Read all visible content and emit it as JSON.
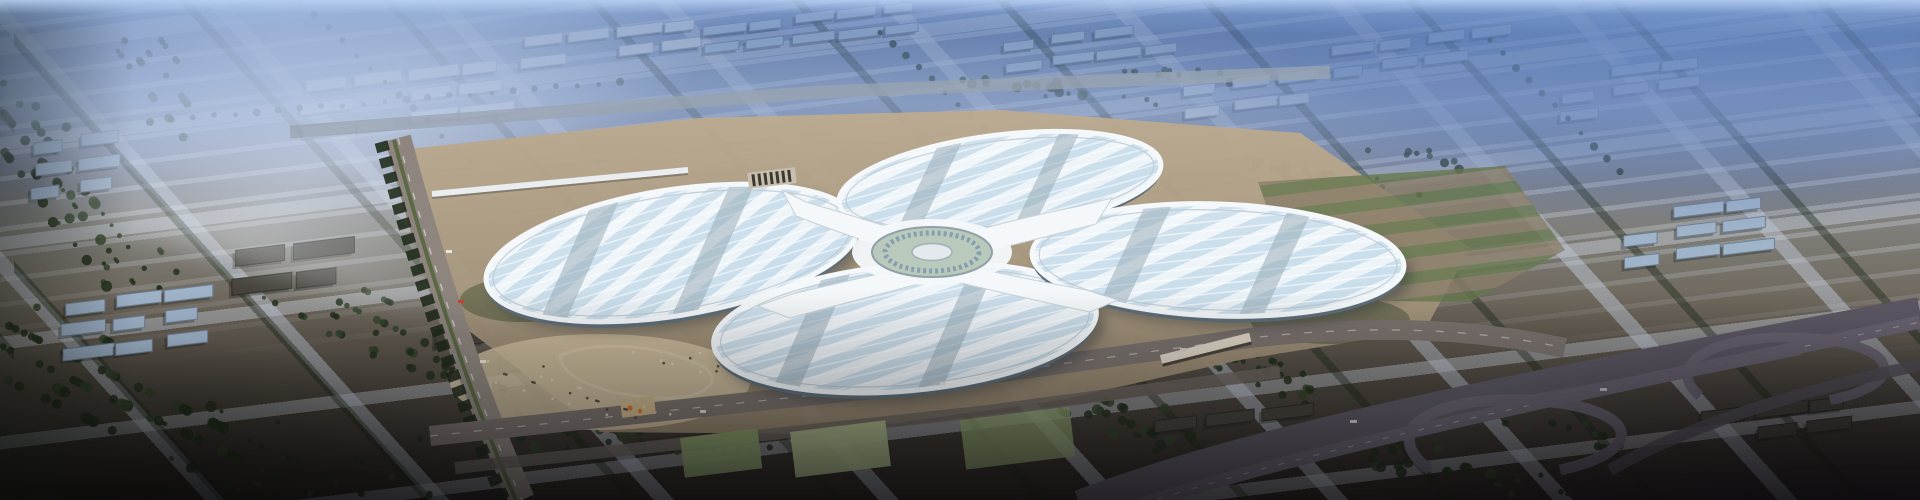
{
  "image": {
    "kind": "aerial architectural rendering",
    "subject": "four-leaf-clover exhibition and convention center in a hazy city grid at dusk",
    "width_px": 1920,
    "height_px": 500,
    "text_content": "none"
  },
  "palette": {
    "ground_top": "#6f87ad",
    "ground_dark": "#27231f",
    "city_building_light": "#c3ccd4",
    "city_building_blue": "#9fb3c9",
    "warehouse_dark": "#45423a",
    "tree_dark": "#22301c",
    "tree_mid": "#33432a",
    "roof_white": "#f2f7fa",
    "roof_panel": "#c7dcea",
    "roof_band": "#93a7b4",
    "roof_wall": "#5d6e7a",
    "rim_white": "#f4f8fa",
    "apron_tan": "#bcab90",
    "apron_deep": "#95866f",
    "plaza_light": "#cdbd9e",
    "court_green": "#8a9e6c",
    "court_pale": "#a7b687",
    "road_warm": "#8d857e",
    "road_dark": "#5d5864",
    "ramp_grey": "#6a6472",
    "hub_court": "#b9c9bb",
    "glass_blue": "#7d98ad",
    "orange_accent": "#d8742c",
    "boulevard_median": "#55663f"
  },
  "scene": {
    "building_clusters": [
      {
        "x": 300,
        "y": 80,
        "cols": 4,
        "rows": 3,
        "w": 46,
        "h": 11,
        "tone": "light"
      },
      {
        "x": 520,
        "y": 36,
        "cols": 4,
        "rows": 2,
        "w": 40,
        "h": 10,
        "tone": "light"
      },
      {
        "x": 60,
        "y": 300,
        "cols": 3,
        "rows": 3,
        "w": 44,
        "h": 12,
        "tone": "blue"
      },
      {
        "x": 30,
        "y": 140,
        "cols": 2,
        "rows": 3,
        "w": 40,
        "h": 12,
        "tone": "blue"
      },
      {
        "x": 700,
        "y": 24,
        "cols": 5,
        "rows": 2,
        "w": 38,
        "h": 9,
        "tone": "blue"
      },
      {
        "x": 1000,
        "y": 40,
        "cols": 4,
        "rows": 2,
        "w": 40,
        "h": 9,
        "tone": "blue"
      },
      {
        "x": 1180,
        "y": 84,
        "cols": 3,
        "rows": 2,
        "w": 42,
        "h": 10,
        "tone": "light"
      },
      {
        "x": 1330,
        "y": 44,
        "cols": 4,
        "rows": 2,
        "w": 40,
        "h": 10,
        "tone": "blue"
      },
      {
        "x": 1560,
        "y": 70,
        "cols": 3,
        "rows": 3,
        "w": 42,
        "h": 10,
        "tone": "blue"
      },
      {
        "x": 1620,
        "y": 210,
        "cols": 3,
        "rows": 3,
        "w": 44,
        "h": 11,
        "tone": "blue"
      },
      {
        "x": 1700,
        "y": 410,
        "cols": 3,
        "rows": 2,
        "w": 46,
        "h": 12,
        "tone": "dark"
      },
      {
        "x": 230,
        "y": 250,
        "cols": 2,
        "rows": 2,
        "w": 56,
        "h": 16,
        "tone": "dark"
      },
      {
        "x": 430,
        "y": 330,
        "cols": 2,
        "rows": 2,
        "w": 60,
        "h": 18,
        "tone": "dark"
      },
      {
        "x": 640,
        "y": 440,
        "cols": 4,
        "rows": 1,
        "w": 44,
        "h": 12,
        "tone": "dark"
      },
      {
        "x": 1150,
        "y": 420,
        "cols": 3,
        "rows": 1,
        "w": 48,
        "h": 12,
        "tone": "dark"
      }
    ],
    "tree_clumps": [
      {
        "x": 0,
        "y": 290,
        "w": 430,
        "h": 205,
        "n": 150
      },
      {
        "x": 430,
        "y": 320,
        "w": 190,
        "h": 130,
        "n": 48
      },
      {
        "x": 0,
        "y": 40,
        "w": 190,
        "h": 250,
        "n": 90
      },
      {
        "x": 560,
        "y": 395,
        "w": 240,
        "h": 60,
        "n": 40
      },
      {
        "x": 1050,
        "y": 360,
        "w": 260,
        "h": 110,
        "n": 66
      },
      {
        "x": 1320,
        "y": 420,
        "w": 300,
        "h": 75,
        "n": 56
      },
      {
        "x": 1240,
        "y": 150,
        "w": 220,
        "h": 46,
        "n": 34
      },
      {
        "x": 960,
        "y": 70,
        "w": 280,
        "h": 36,
        "n": 30
      }
    ],
    "tree_rows": [
      {
        "x1": 300,
        "y1": 0,
        "x2": 470,
        "y2": 160,
        "n": 12
      },
      {
        "x1": 880,
        "y1": 30,
        "x2": 1010,
        "y2": 150,
        "n": 10
      },
      {
        "x1": 1490,
        "y1": 40,
        "x2": 1620,
        "y2": 170,
        "n": 10
      },
      {
        "x1": 420,
        "y1": 438,
        "x2": 1000,
        "y2": 392,
        "n": 26
      },
      {
        "x1": 1010,
        "y1": 392,
        "x2": 1280,
        "y2": 350,
        "n": 12
      },
      {
        "x1": 150,
        "y1": 120,
        "x2": 620,
        "y2": 80,
        "n": 22
      }
    ],
    "crowd_dots": {
      "x": 480,
      "y": 348,
      "w": 240,
      "h": 70,
      "n": 34
    }
  }
}
